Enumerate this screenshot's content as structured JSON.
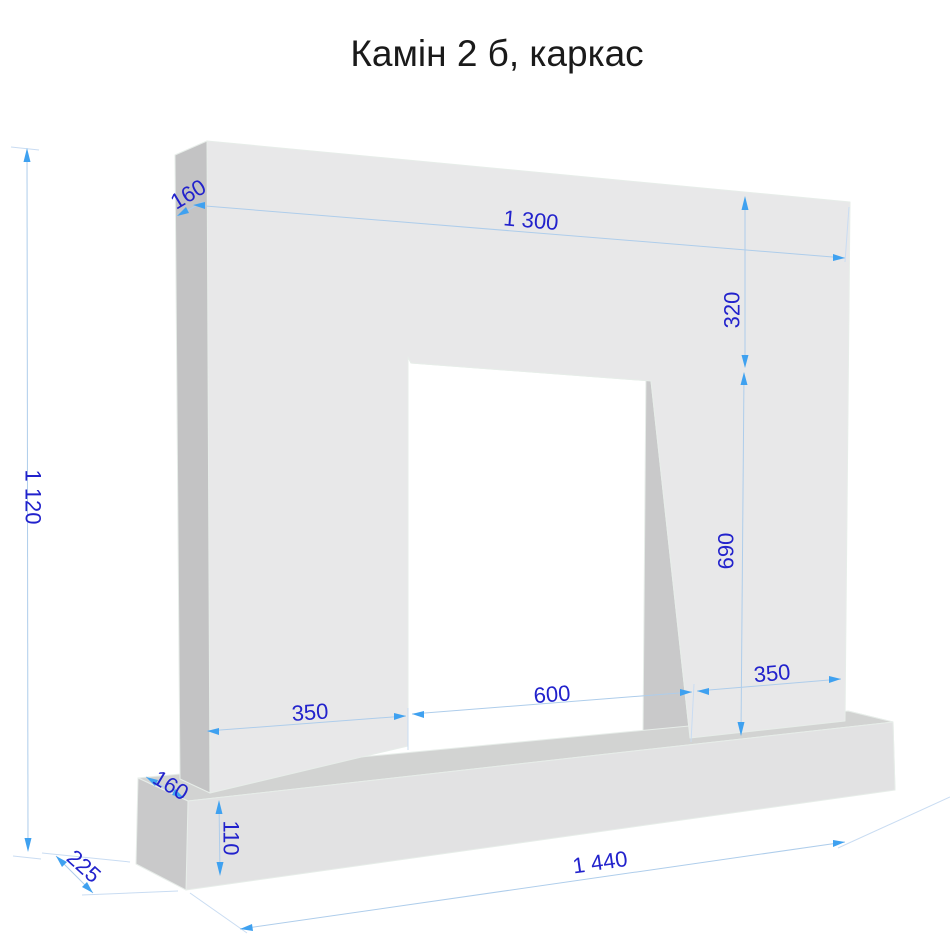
{
  "title": "Камін 2 б, каркас",
  "dimensions": {
    "total_height": "1 120",
    "frame_depth": "160",
    "frame_width": "1 300",
    "lintel_height": "320",
    "opening_height": "690",
    "right_leg_width": "350",
    "opening_width": "600",
    "left_leg_width": "350",
    "base_ledge_depth": "160",
    "base_height": "110",
    "base_depth": "225",
    "base_width": "1 440"
  },
  "colors": {
    "title_color": "#1a1a1a",
    "dimension_text": "#2222cc",
    "dimension_line": "#aecdeb",
    "dimension_line_light": "#c9dcf2",
    "dimension_arrow": "#3fa1f0",
    "frame_front": "#e8e8e9",
    "frame_side": "#c3c3c4",
    "soffit": "#b2b2b3",
    "reveal": "#c9c9ca",
    "base_top": "#d2d3d2",
    "base_front": "#e2e2e3",
    "base_side": "#c9c9ca",
    "base_end": "#dadadb",
    "background": "#ffffff"
  }
}
